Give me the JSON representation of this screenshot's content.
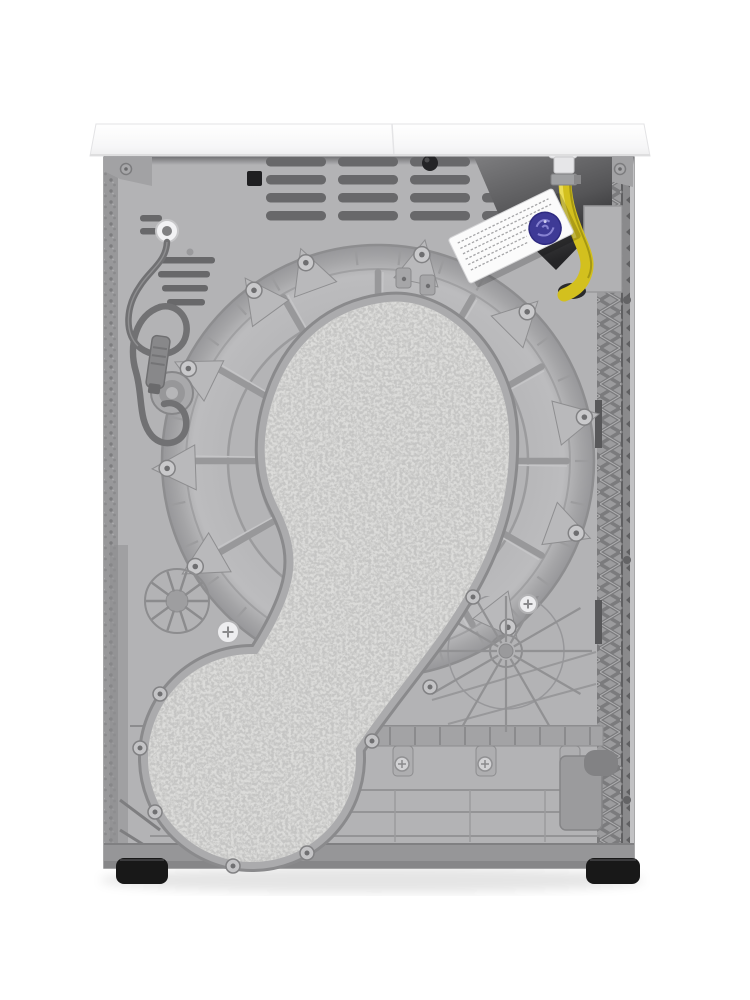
{
  "scene": {
    "subject": "rear view of a freestanding tumble dryer appliance",
    "background": "#ffffff"
  },
  "colors": {
    "top_panel": "#f7f7f8",
    "top_panel_edge": "#dededf",
    "body": "#b3b3b5",
    "panel_shadow": "#7e7e80",
    "vent": "#68686a",
    "vent_clip_black": "#1f1f21",
    "grommet_black": "#242426",
    "recess_top": "#7d7d7f",
    "recess_bottom": "#2e2e30",
    "junction_box": "#b1b1b3",
    "hose_yellow": "#d3c01e",
    "hose_highlight": "#efe260",
    "hose_shadow": "#9a8d10",
    "connector_white": "#efeff1",
    "clamp_gray": "#9fa0a2",
    "label_white": "#fbfbfb",
    "label_text_gray": "#a5a5a7",
    "stamp_blue": "#3e3a96",
    "stamp_blue_light": "#8f8bd8",
    "drum_gray": "#b1b1b3",
    "drum_ring_line": "#8f8f91",
    "drum_rib": "#98989a",
    "gusset_gray": "#b9b9bb",
    "screw_boss": "#c9c9cb",
    "felt_base": "#dcdcda",
    "felt_speckle": "#8f8f8f",
    "felt_rim": "#ababad",
    "felt_rim_dark": "#8a8a8c",
    "cord_gray": "#717173",
    "plug_gray": "#88888a",
    "cable_grommet_white": "#f2f2f4",
    "left_trim": "#98989a",
    "lattice_bg": "#9c9c9e",
    "lattice_line": "#7b7b7d",
    "zigzag_dark": "#606062",
    "base_gray": "#a7a7a9",
    "base_rib": "#929294",
    "base_strip": "#969698",
    "foot_black": "#181818",
    "ground_shadow": "rgba(0,0,0,0.10)"
  },
  "components": {
    "top_panel": "worktop edge",
    "rear_panel": "rear sheet panel with ventilation slots",
    "power_cord": "coiled power cord with plug",
    "drum_bulkhead": "round rear drum housing with radial ribs",
    "insulation_pads": "speckled felt insulation pads over air duct",
    "drain_hose": "yellow drain hose with white connector and clamp",
    "rating_label": "white sticker with fine print and blue inspection stamp",
    "side_trims": "left textured trim and right lattice side frame",
    "base": "molded plastic base with ribs and screw tabs",
    "feet": "two black leveling feet"
  }
}
